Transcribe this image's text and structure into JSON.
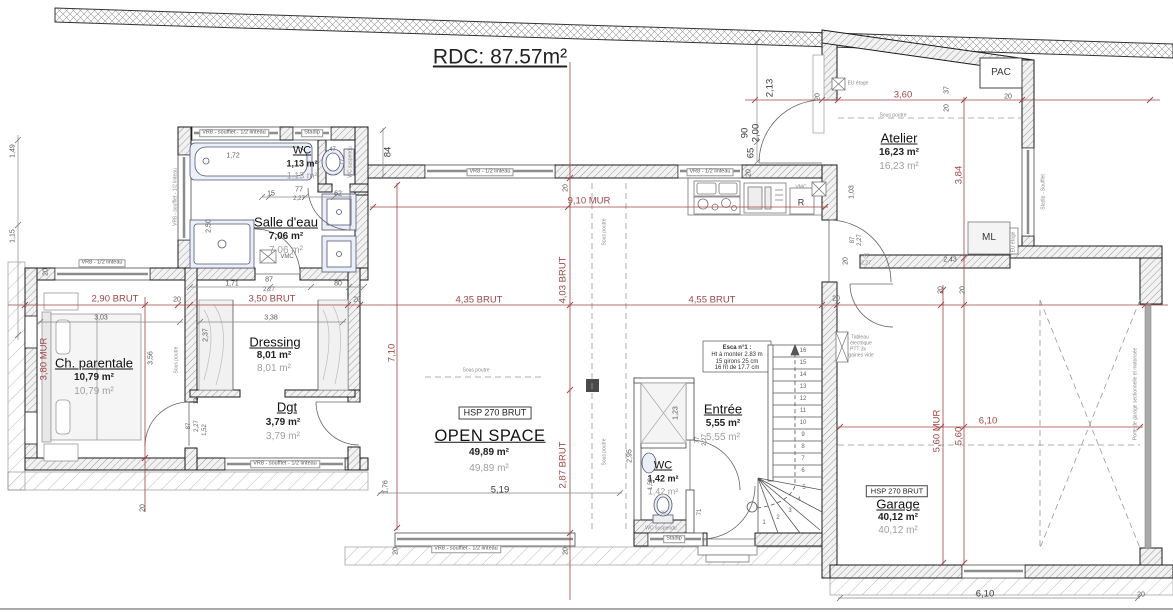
{
  "plan": {
    "title": "RDC: 87.57m²",
    "rooms": {
      "wc1": {
        "name": "WC",
        "a": "1,13 m²",
        "b": "1,13 m²"
      },
      "sde": {
        "name": "Salle d'eau",
        "a": "7,06 m²",
        "b": "7,06 m²"
      },
      "chp": {
        "name": "Ch. parentale",
        "a": "10,79 m²",
        "b": "10,79 m²"
      },
      "dre": {
        "name": "Dressing",
        "a": "8,01 m²",
        "b": "8,01 m²"
      },
      "dgt": {
        "name": "Dgt",
        "a": "3,79 m²",
        "b": "3,79 m²"
      },
      "osp": {
        "name": "OPEN SPACE",
        "a": "49,89 m²",
        "b": "49,89 m²"
      },
      "ent": {
        "name": "Entrée",
        "a": "5,55 m²",
        "b": "5,55 m²"
      },
      "wc2": {
        "name": "WC",
        "a": "1,42 m²",
        "b": "1,42 m²"
      },
      "ate": {
        "name": "Atelier",
        "a": "16,23 m²",
        "b": "16,23 m²"
      },
      "gar": {
        "name": "Garage",
        "a": "40,12 m²",
        "b": "40,12 m²"
      }
    },
    "boxes": {
      "hsp": "HSP 270 BRUT",
      "pac": "PAC",
      "ml": "ML",
      "r": "R",
      "vmc": "VMC",
      "stadip": "Stadip"
    },
    "esca": {
      "l1": "Esca n°1 :",
      "l2": "Ht à monter 2.83 m",
      "l3": "15 girons 25 cm",
      "l4": "16 ht de 17.7 cm"
    },
    "win": {
      "a": "VR8 - soufflet - 1/2 linteau",
      "b": "VR8 - 1/2 linteau",
      "c": "Stadip - Soufflet"
    },
    "ann": {
      "sp": "Sous poutre",
      "wcs": "WC suspendu",
      "eu": "EU étage",
      "pg": "Porte de garage sectionnelle et motorisée",
      "t1": "Tableau",
      "t2": "électrique",
      "t3": "PTT 3x",
      "t4": "gaines vide"
    },
    "dim": {
      "d20": "20",
      "d290": "2,90 BRUT",
      "d350": "3,50 BRUT",
      "d435": "4,35 BRUT",
      "d455": "4,55 BRUT",
      "d910": "9,10 MUR",
      "d403": "4,03 BRUT",
      "d287": "2,87 BRUT",
      "d380": "3,80 MUR",
      "d560m": "5,60 MUR",
      "d560": "5,60",
      "d610": "6,10",
      "d360": "3,60",
      "d384": "3,84",
      "d710": "7,10",
      "d213": "2,13",
      "d90": "90",
      "d200": "2,00",
      "d65": "65",
      "d84": "84",
      "d37": "37",
      "d303": "3,03",
      "d338": "3,38",
      "d171": "1,71",
      "d87": "87",
      "d227": "2,27",
      "d80": "80",
      "d15": "15",
      "d77": "77",
      "d62": "62",
      "d147": "1,47",
      "d172": "1,72",
      "d250": "2,50",
      "d237": "2,37",
      "d356": "3,56",
      "d12": "12",
      "d152": "1,52",
      "d519": "5,19",
      "d176": "1,76",
      "d295": "2,95",
      "d123": "1,23",
      "d71": "71",
      "d158": "1,58",
      "d103": "1,03",
      "d243": "2,43",
      "d149": "1,49",
      "d115": "1,15"
    },
    "stairs": {
      "numbers": [
        "1",
        "2",
        "3",
        "4",
        "5",
        "6",
        "7",
        "8",
        "9",
        "10",
        "11",
        "12",
        "13",
        "14",
        "15",
        "16"
      ]
    }
  }
}
